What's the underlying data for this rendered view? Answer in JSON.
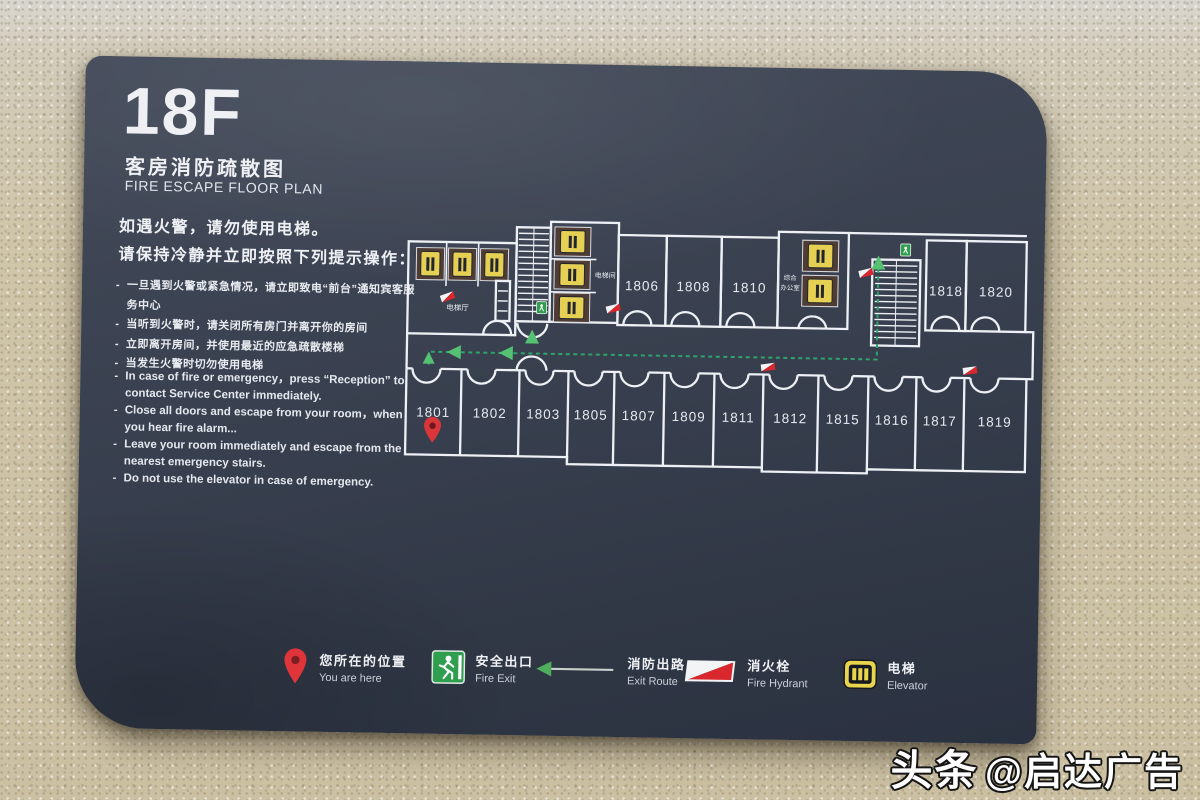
{
  "sign": {
    "floor": "18F",
    "title_zh": "客房消防疏散图",
    "title_en": "FIRE ESCAPE FLOOR PLAN",
    "intro_zh": "如遇火警，请勿使用电梯。\n请保持冷静并立即按照下列提示操作：",
    "instructions_zh": [
      "一旦遇到火警或紧急情况，请立即致电“前台”通知宾客服务中心",
      "当听到火警时，请关闭所有房门并离开你的房间",
      "立即离开房间，并使用最近的应急疏散楼梯",
      "当发生火警时切勿使用电梯"
    ],
    "instructions_en": [
      "In case of fire or emergency，press “Reception” to contact Service Center immediately.",
      "Close all doors and escape from your room，when you hear fire alarm...",
      "Leave your room immediately and escape from the nearest emergency stairs.",
      "Do not use the elevator in case of emergency."
    ]
  },
  "floor_plan": {
    "labels": {
      "elevator_hall": "电梯厅",
      "elevator_room": "电梯间",
      "office_line1": "综合",
      "office_line2": "办公室"
    },
    "top_rooms": [
      "1806",
      "1808",
      "1810",
      "1818",
      "1820"
    ],
    "bottom_rooms": [
      "1801",
      "1802",
      "1803",
      "1805",
      "1807",
      "1809",
      "1811",
      "1812",
      "1815",
      "1816",
      "1817",
      "1819"
    ],
    "you_are_here_room": "1801"
  },
  "legend": [
    {
      "icon": "location-pin",
      "zh": "您所在的位置",
      "en": "You are here"
    },
    {
      "icon": "fire-exit",
      "zh": "安全出口",
      "en": "Fire Exit"
    },
    {
      "icon": "exit-route-arrow",
      "zh": "消防出路",
      "en": "Exit Route"
    },
    {
      "icon": "fire-hydrant",
      "zh": "消火栓",
      "en": "Fire Hydrant"
    },
    {
      "icon": "elevator",
      "zh": "电梯",
      "en": "Elevator"
    }
  ],
  "watermark": {
    "brand": "头条",
    "handle": "@启达广告"
  },
  "colors": {
    "board": "#363d4c",
    "wall": "#cfc5a9",
    "wall_line": "#edf0f4",
    "route_green": "#2ea36b",
    "arrow_green": "#54c173",
    "exit_green": "#2f9e4f",
    "hydrant_red": "#d8272d",
    "elevator_yellow": "#e5d054",
    "pin_red": "#d9363c"
  }
}
